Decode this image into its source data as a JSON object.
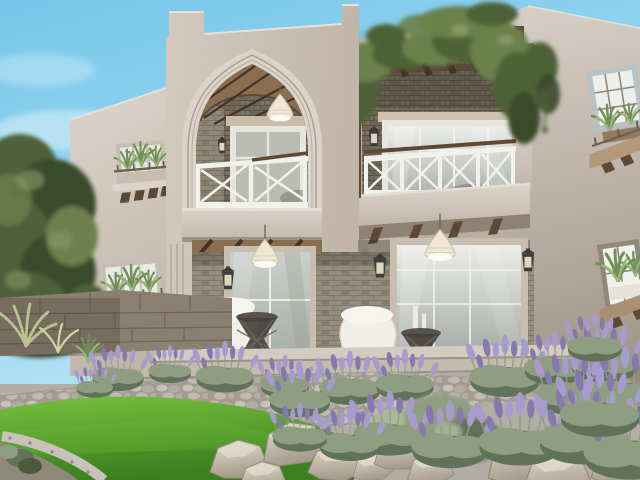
{
  "scene": {
    "type": "architectural-exterior-render",
    "description": "Photorealistic rendering of a two-story Mediterranean villa with a tall pointed central arch loggia, vine-covered pergola terrace, white cross-braced balcony railings, large glass patio doors with wall lanterns and pendant lights, planter windows, a cobblestone path, green lawn, boulders and lavender garden under a clear blue sky",
    "elements": [
      "sky",
      "clouds",
      "olive-trees",
      "stone-garden-wall",
      "left-wing-wall",
      "planter-window-upper-left",
      "planter-window-lower-left",
      "central-tower",
      "pointed-arch-molding",
      "upper-loggia",
      "loggia-railing",
      "loggia-door",
      "wicker-pendant-light",
      "balcony-parapet",
      "pergola",
      "hanging-vines",
      "terrace-balcony",
      "terrace-railing",
      "terrace-door",
      "right-wall",
      "planter-window-upper-right",
      "planter-window-lower-right",
      "ground-porch",
      "left-glass-door",
      "right-glass-door",
      "wall-lanterns",
      "pendant-cones",
      "white-armchair",
      "white-bench",
      "wire-side-tables",
      "candles",
      "porch-floor",
      "stone-steps",
      "cobblestone-path",
      "lawn",
      "gravel-edging",
      "boulders",
      "lavender-bushes",
      "sage-shrubs",
      "yucca-plant",
      "grass-tufts"
    ]
  },
  "palette": {
    "sky_top": "#74c7ec",
    "sky_mid": "#9ddaf2",
    "sky_low": "#c9ecf8",
    "cloud": "#eaf7fc",
    "leaf_dark": "#39482a",
    "leaf_mid": "#4e5f38",
    "leaf_light": "#6c7f4b",
    "leaf_hi": "#8da06a",
    "wall_hi": "#dcd5cc",
    "wall_light": "#d3cabf",
    "wall_mid": "#c2b6aa",
    "wall_dark": "#a2968a",
    "wall_deep": "#8d8174",
    "molding": "#dcd4ca",
    "molding_line": "#a89c8f",
    "brick": "#958d7c",
    "brick_dark": "#6c6557",
    "brick_line": "#7f7868",
    "wood": "#8a6d4f",
    "wood_dark": "#5b4733",
    "wood_deep": "#403122",
    "rail_white": "#f3f2ec",
    "frame_beige": "#c8bfb0",
    "frame_gray": "#b9c2c4",
    "frame_taupe": "#8f8779",
    "glass_hi": "#edefe9",
    "glass_mid": "#ccd1cb",
    "glass_lo": "#a9afa9",
    "pendant": "#efe8d6",
    "plant_green": "#6f8f55",
    "plant_light": "#9ab87a",
    "vine": "#4c6134",
    "vine_light": "#69814a",
    "lawn_hi": "#76c13c",
    "lawn_mid": "#53a02a",
    "lawn_dark": "#3a7f1c",
    "path_base": "#b3aea5",
    "cobble": "#a19c92",
    "cobble_hi": "#c8c3ba",
    "step_top": "#d3ccc2",
    "step_mid": "#c4bcb0",
    "step_low": "#b5ada0",
    "riser": "#9a9286",
    "rock_hi": "#e6dfd1",
    "rock_mid": "#c8c0b0",
    "rock_dark": "#a49c8c",
    "rock_line": "#8f8778",
    "lavender": "#a79bce",
    "lavender_dark": "#8478ad",
    "sage": "#8e9e80",
    "sage_dark": "#5f7157",
    "sage_light": "#aab89a",
    "stone_wall": "#8a7f6f",
    "stone_dark": "#6b6254",
    "metal": "#3c3a36",
    "shadow": "#2e2a24",
    "candle": "#efece2"
  }
}
